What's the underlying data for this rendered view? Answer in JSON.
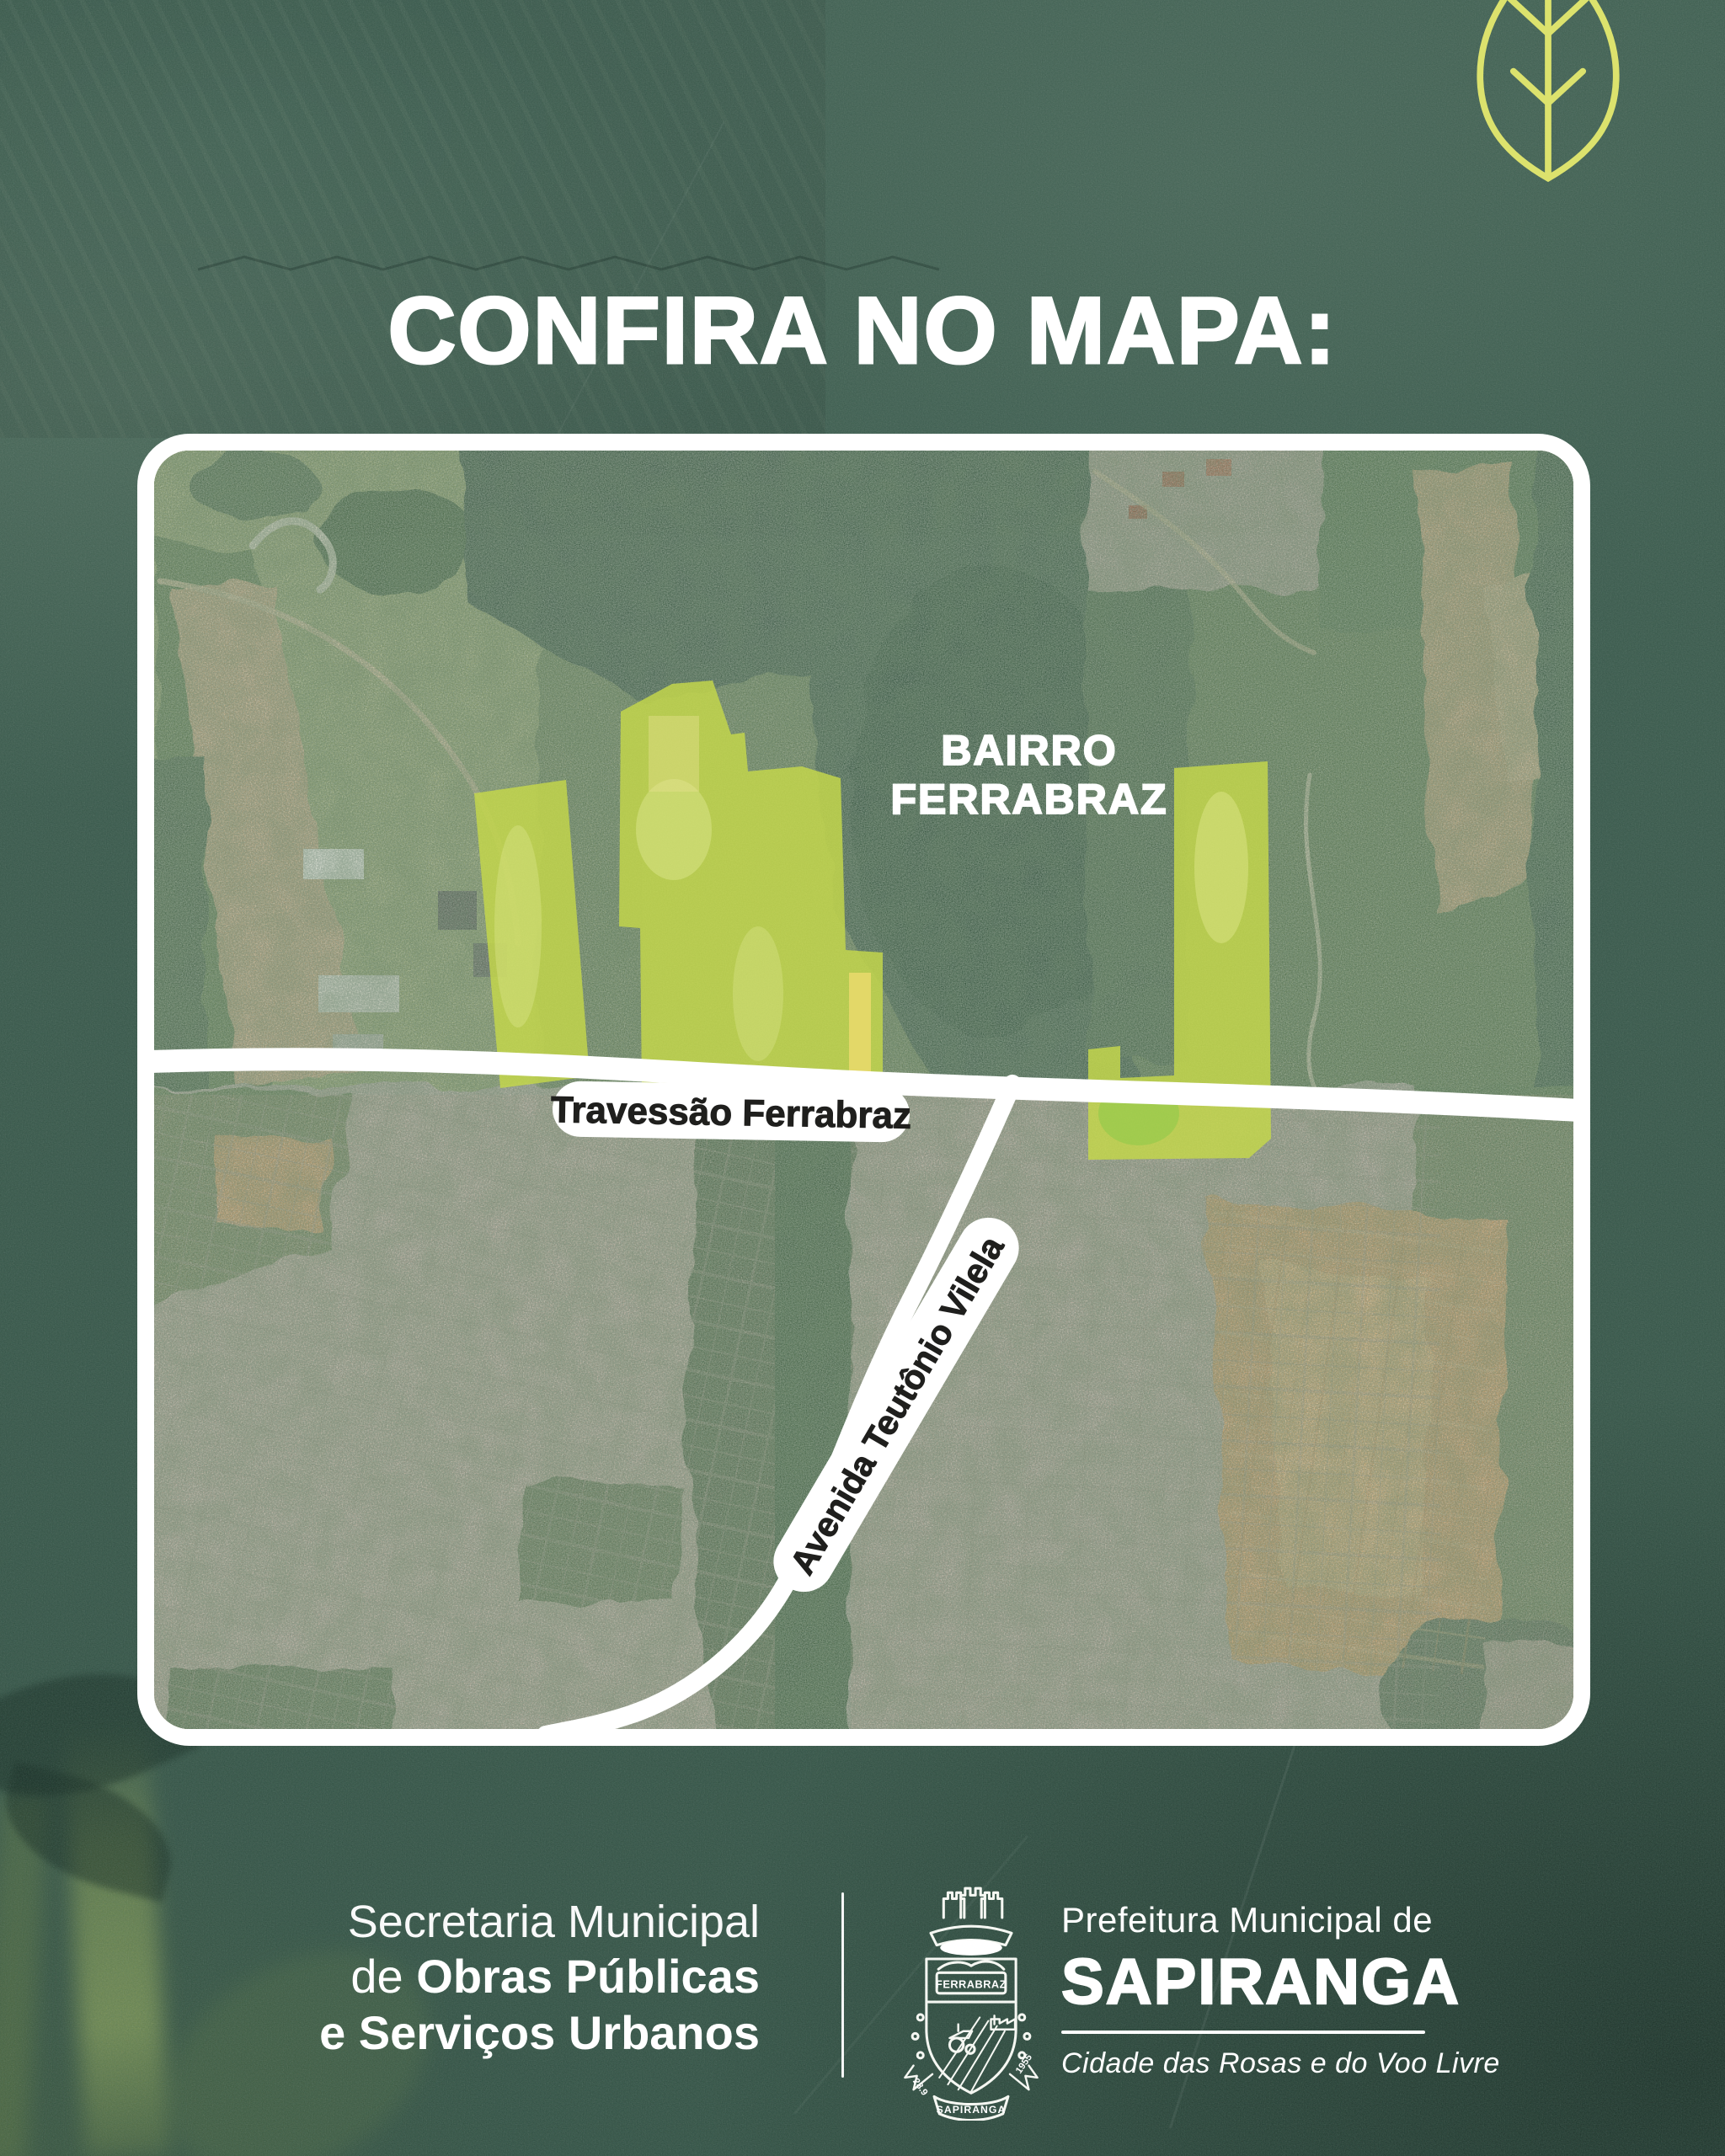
{
  "poster": {
    "title": "CONFIRA NO MAPA:"
  },
  "map": {
    "area_label_line1": "BAIRRO",
    "area_label_line2": "FERRABRAZ",
    "road_label_horizontal": "Travessão Ferrabraz",
    "road_label_diagonal": "Avenida Teutônio Vilela",
    "highlight_color": "#c3d64b"
  },
  "footer": {
    "left_line1": "Secretaria Municipal",
    "left_line2_prefix": "de ",
    "left_line2_bold": "Obras Públicas",
    "left_line3": "e Serviços Urbanos",
    "crest": {
      "banner": "FERRABRAZ",
      "ribbon_left": "28.9",
      "ribbon_right": "1955",
      "ribbon_bottom": "SAPIRANGA"
    },
    "right_line1": "Prefeitura Municipal de",
    "right_city": "SAPIRANGA",
    "right_slogan": "Cidade das Rosas e do Voo Livre"
  },
  "colors": {
    "background": "#37584a",
    "accent_leaf": "#dce26d",
    "highlight": "#c3d64b",
    "road": "#ffffff",
    "label_text_dark": "#1f1f1d"
  }
}
